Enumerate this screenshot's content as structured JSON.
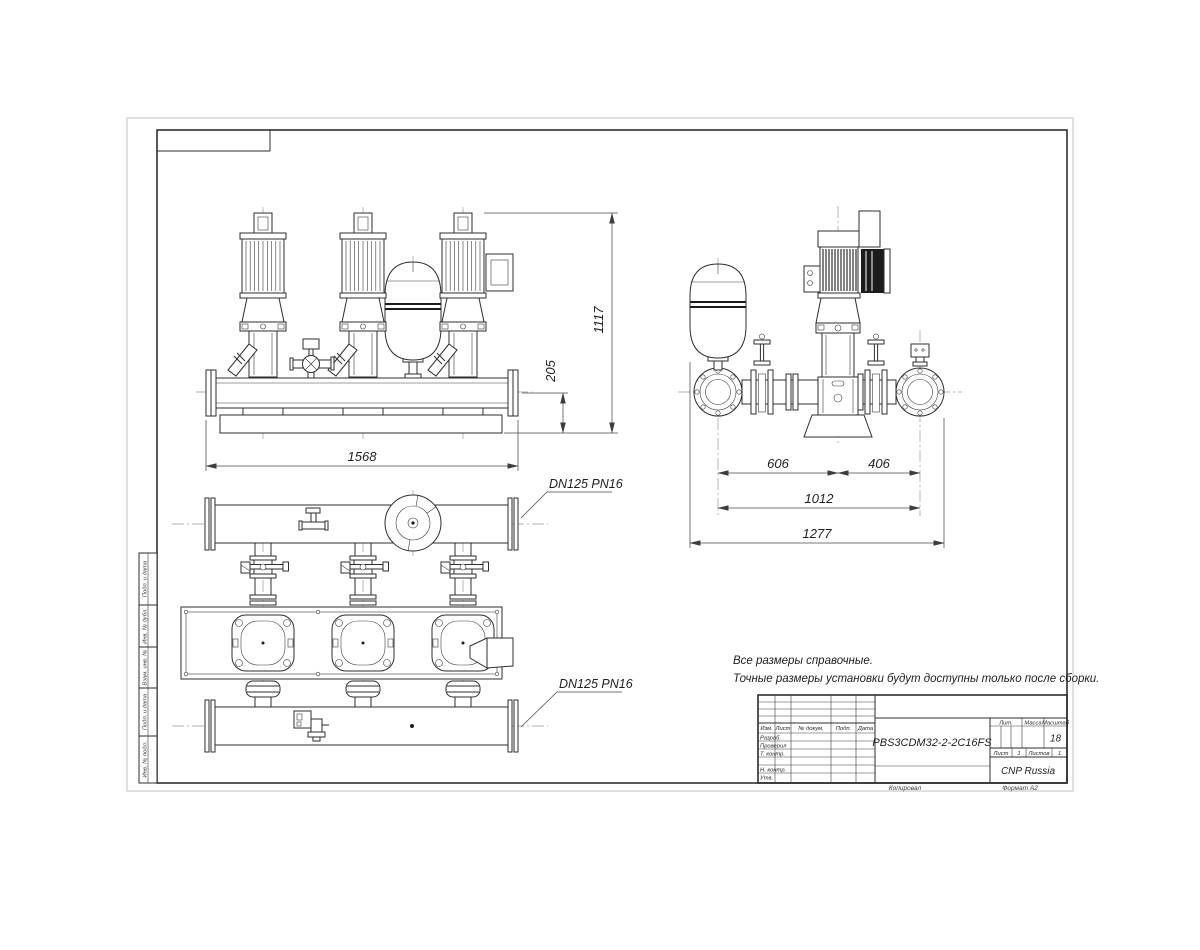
{
  "drawing": {
    "dimensions": {
      "front_width": "1568",
      "front_height": "1117",
      "manifold_height": "205",
      "side_left_span": "606",
      "side_right_span": "406",
      "side_inner_span": "1012",
      "side_total_span": "1277"
    },
    "labels": {
      "flange_top": "DN125 PN16",
      "flange_bottom": "DN125 PN16"
    },
    "notes": {
      "line1": "Все размеры справочные.",
      "line2": "Точные размеры установки будут доступны только после сборки."
    },
    "colors": {
      "line": "#2e2e2e",
      "centerline": "#999999",
      "background": "#ffffff"
    }
  },
  "title_block": {
    "designation": "PBS3CDM32-2-2C16FS",
    "company": "CNP Russia",
    "scale_value": "18",
    "sheet_number": "1",
    "sheets_total": "1",
    "headers": {
      "izm": "Изм.",
      "list": "Лист",
      "doc": "№ докум.",
      "podp": "Подп.",
      "data": "Дата",
      "lit": "Лит.",
      "massa": "Масса",
      "masshtab": "Масштаб",
      "list2": "Лист",
      "listov": "Листов"
    },
    "rows": {
      "razrab": "Разраб.",
      "prover": "Проверил",
      "tkontr": "Т. контр.",
      "nkontr": "Н. контр.",
      "utv": "Утв."
    },
    "footer": {
      "copied": "Копировал",
      "format": "Формат А2"
    }
  },
  "margin_stamps": {
    "stamp1": "Подп. и дата",
    "stamp2": "Инв. № дубл.",
    "stamp3": "Взам. инв. №",
    "stamp4": "Подп. и дата",
    "stamp5": "Инв. № подл."
  }
}
